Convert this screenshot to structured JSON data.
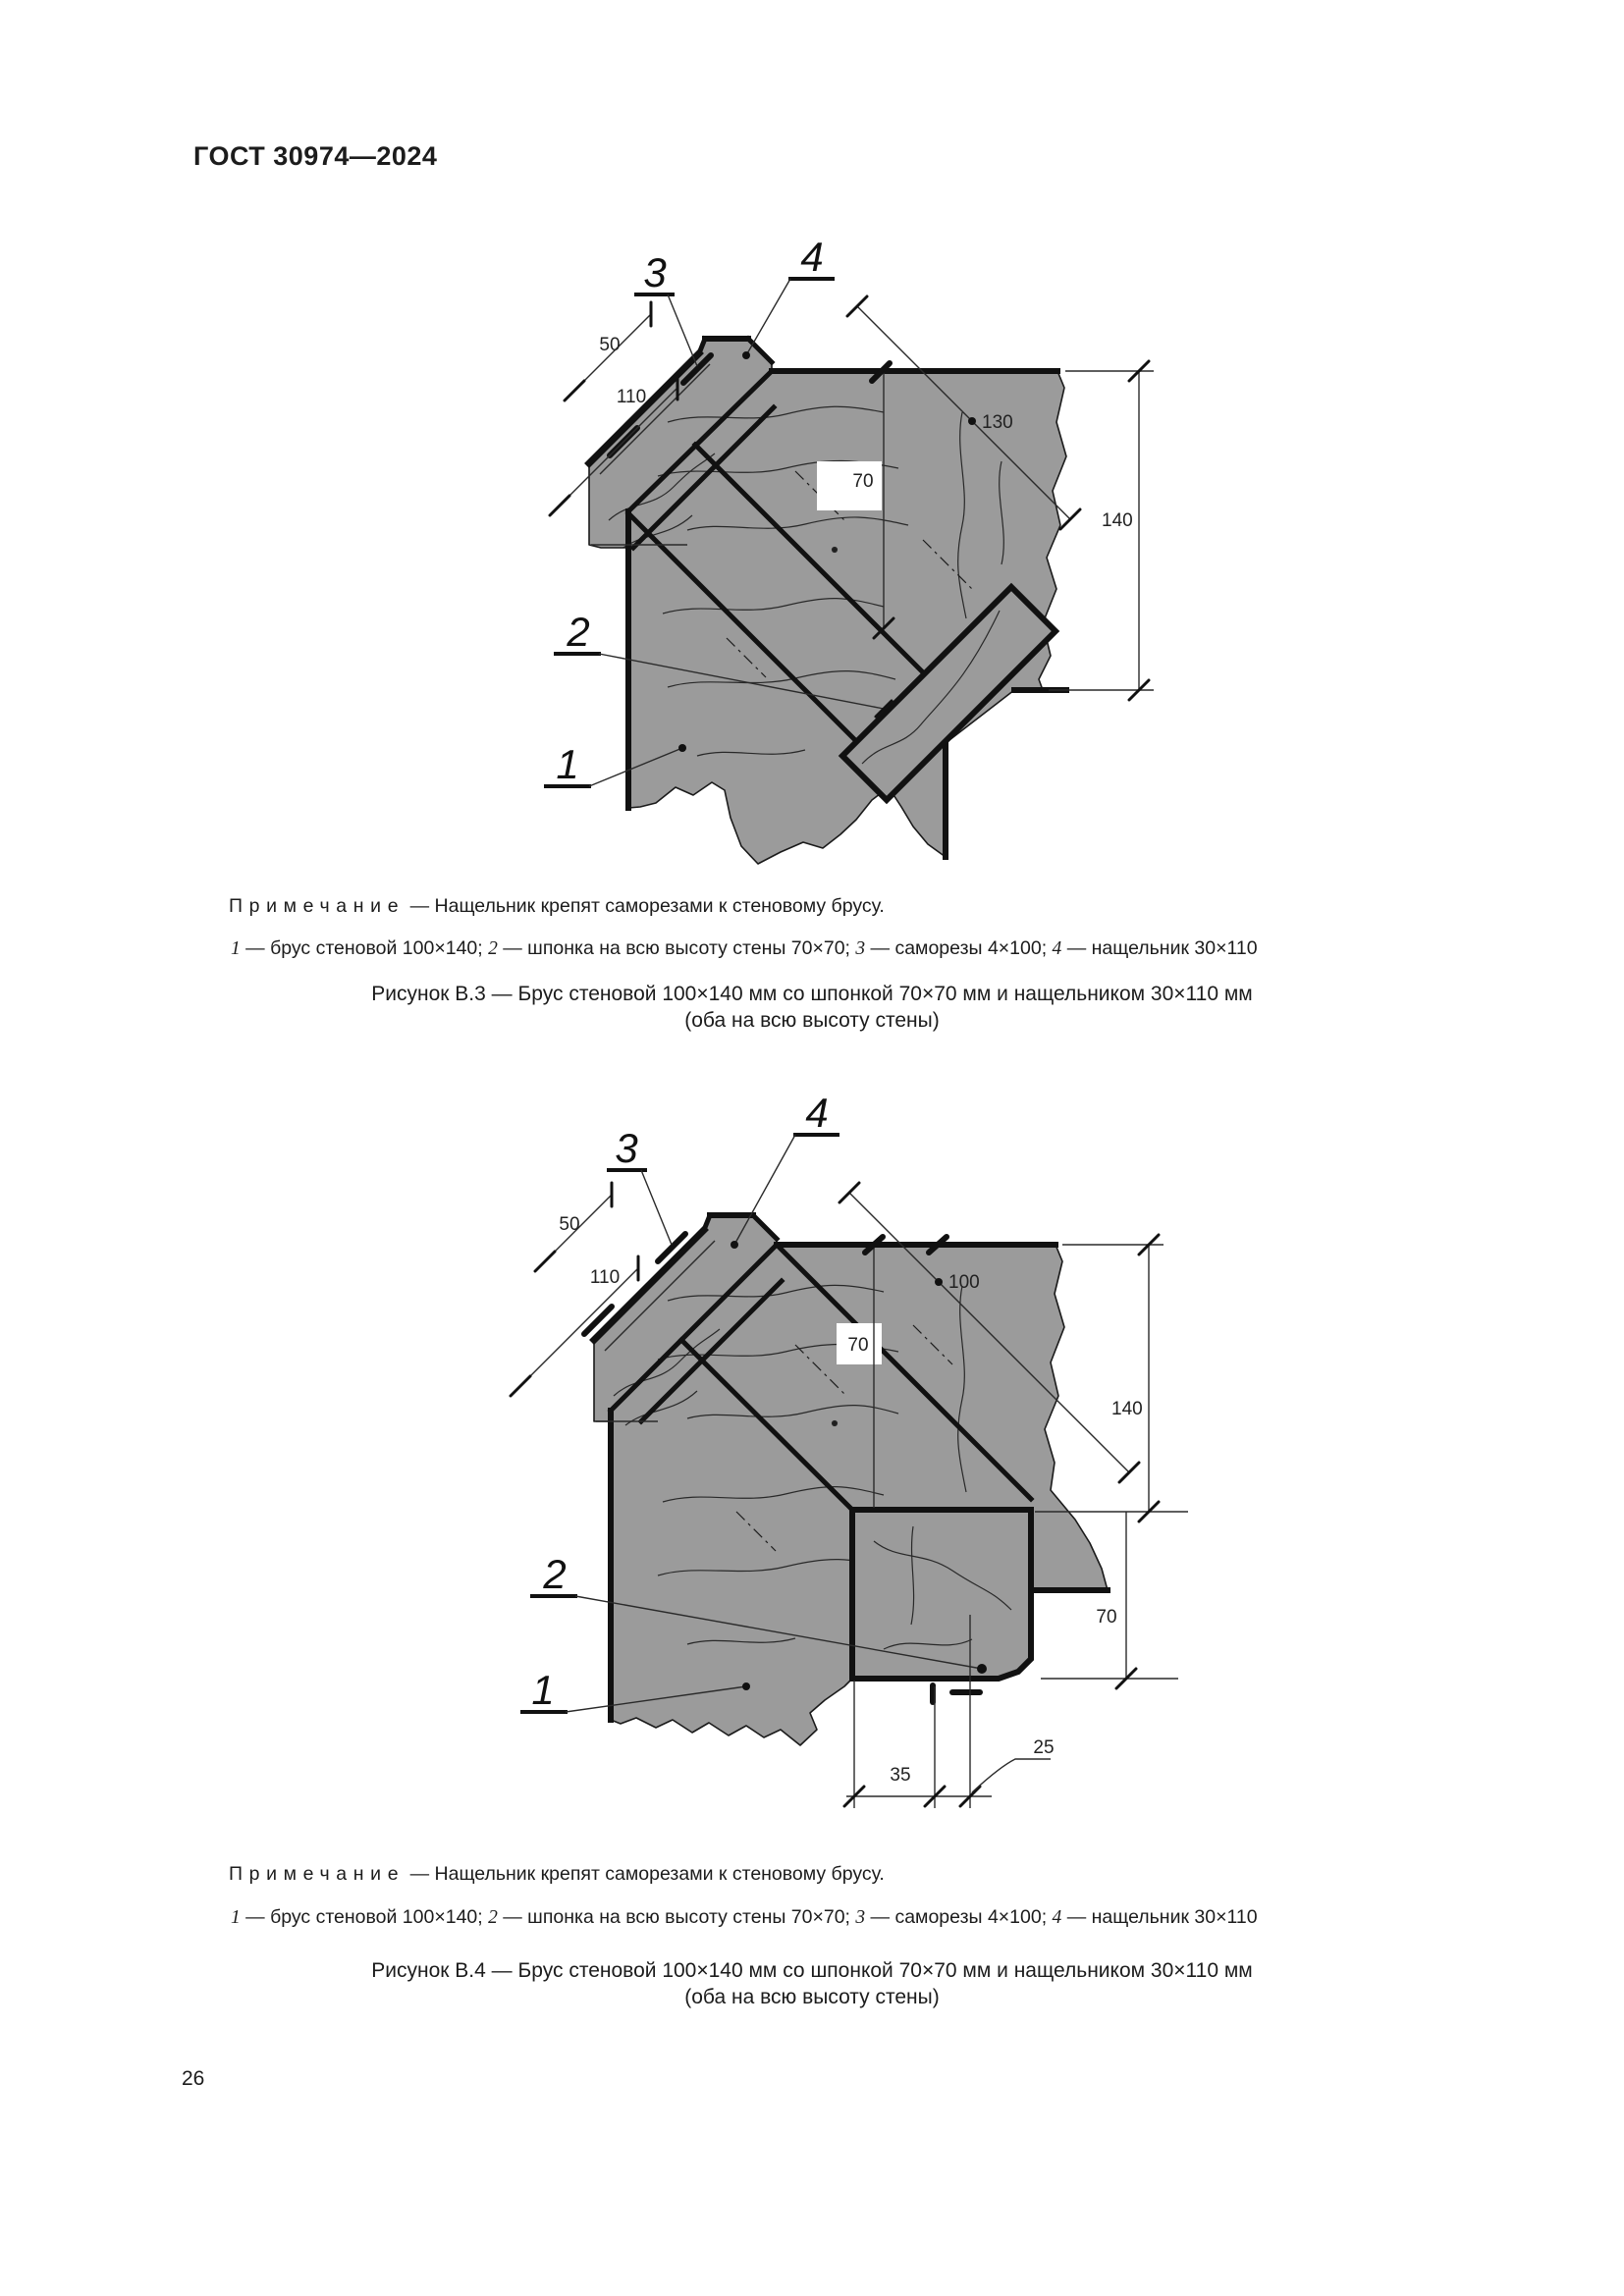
{
  "page": {
    "header": "ГОСТ 30974—2024",
    "page_number": "26"
  },
  "figures": [
    {
      "id": "B3",
      "note_label": "Примечание",
      "note_dash": "—",
      "note_text": "Нащельник крепят саморезами к стеновому брусу.",
      "legend": [
        {
          "num": "1",
          "text": "брус стеновой 100×140"
        },
        {
          "num": "2",
          "text": "шпонка на всю высоту стены 70×70"
        },
        {
          "num": "3",
          "text": "саморезы 4×100"
        },
        {
          "num": "4",
          "text": "нащельник 30×110"
        }
      ],
      "caption_line1": "Рисунок В.3 — Брус стеновой 100×140 мм со шпонкой 70×70 мм и нащельником 30×110 мм",
      "caption_line2": "(оба на всю высоту стены)",
      "callouts": {
        "c1": "1",
        "c2": "2",
        "c3": "3",
        "c4": "4"
      },
      "dims": {
        "d50": "50",
        "d110": "110",
        "d130": "130",
        "d70": "70",
        "d140": "140"
      }
    },
    {
      "id": "B4",
      "note_label": "Примечание",
      "note_dash": "—",
      "note_text": "Нащельник крепят саморезами к стеновому брусу.",
      "legend": [
        {
          "num": "1",
          "text": "брус стеновой 100×140"
        },
        {
          "num": "2",
          "text": "шпонка на всю высоту стены 70×70"
        },
        {
          "num": "3",
          "text": "саморезы 4×100"
        },
        {
          "num": "4",
          "text": "нащельник 30×110"
        }
      ],
      "caption_line1": "Рисунок В.4 — Брус стеновой 100×140 мм со шпонкой 70×70 мм и нащельником 30×110 мм",
      "caption_line2": "(оба на всю высоту стены)",
      "callouts": {
        "c1": "1",
        "c2": "2",
        "c3": "3",
        "c4": "4"
      },
      "dims": {
        "d50": "50",
        "d110": "110",
        "d100": "100",
        "d70mid": "70",
        "d140": "140",
        "d70r": "70",
        "d35": "35",
        "d25": "25"
      }
    }
  ]
}
